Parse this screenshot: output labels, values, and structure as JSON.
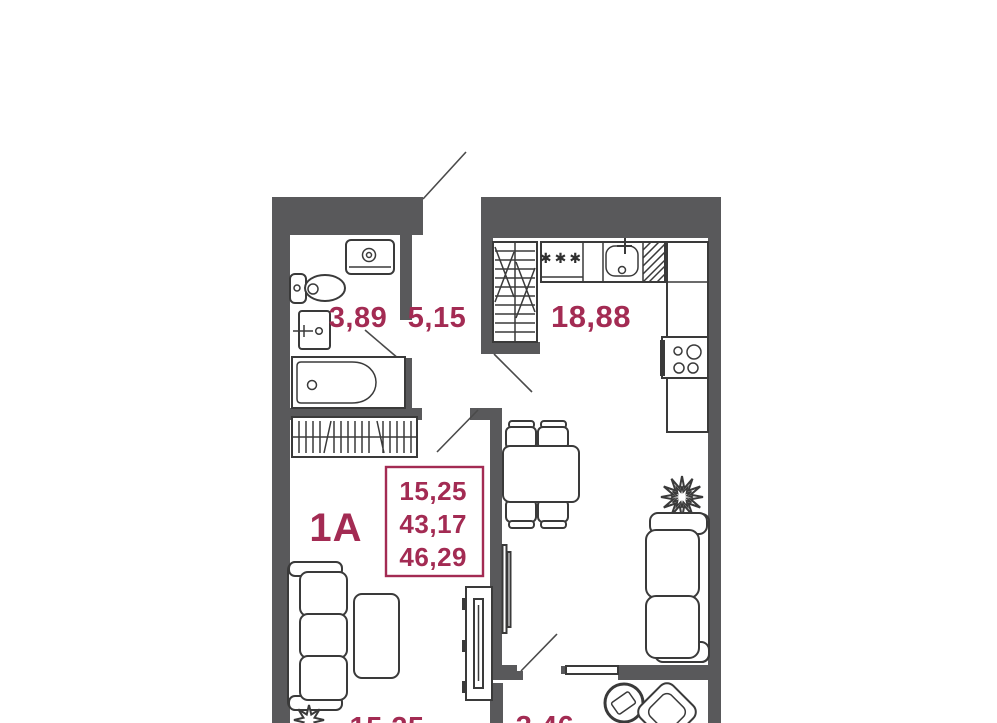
{
  "plan": {
    "unit_type": "1А",
    "summary_box": {
      "living_area": "15,25",
      "area_without_balcony": "43,17",
      "total_area": "46,29"
    },
    "rooms": {
      "bathroom": "3,89",
      "hallway": "5,15",
      "kitchen_living": "18,88",
      "bedroom_partial": "15,25",
      "balcony_partial": "3,46"
    },
    "symbols": {
      "stove_marking": "✱✱✱"
    },
    "colors": {
      "accent": "#A32B53",
      "wall": "#59595B",
      "furniture_stroke": "#3a3a3a"
    }
  }
}
